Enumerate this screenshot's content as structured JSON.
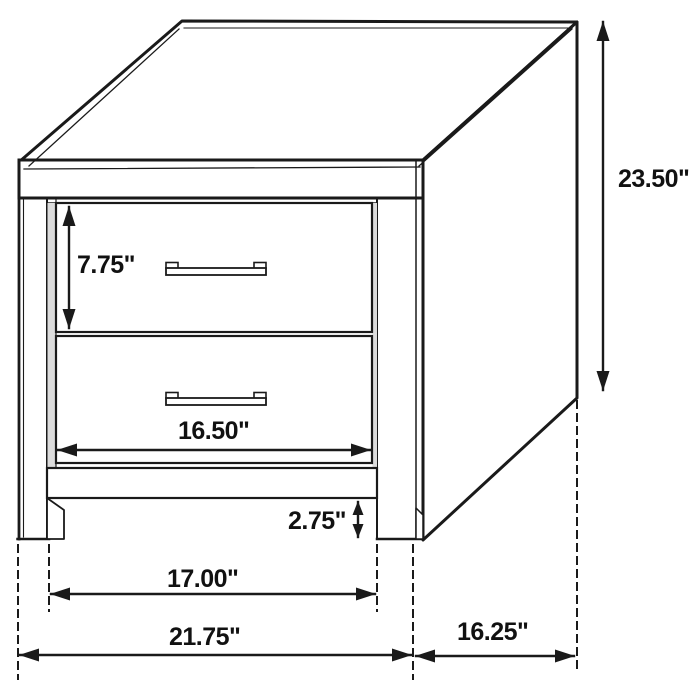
{
  "diagram": {
    "subject": "2-drawer nightstand dimension drawing",
    "unit": "inches",
    "line_color": "#1a1a1a",
    "background_color": "#ffffff",
    "dimensions": {
      "top_drawer_height": {
        "label": "7.75\"",
        "value": 7.75
      },
      "overall_height": {
        "label": "23.50\"",
        "value": 23.5
      },
      "drawer_width": {
        "label": "16.50\"",
        "value": 16.5
      },
      "leg_clearance": {
        "label": "2.75\"",
        "value": 2.75
      },
      "inner_leg_span": {
        "label": "17.00\"",
        "value": 17.0
      },
      "overall_width": {
        "label": "21.75\"",
        "value": 21.75
      },
      "overall_depth": {
        "label": "16.25\"",
        "value": 16.25
      }
    }
  }
}
